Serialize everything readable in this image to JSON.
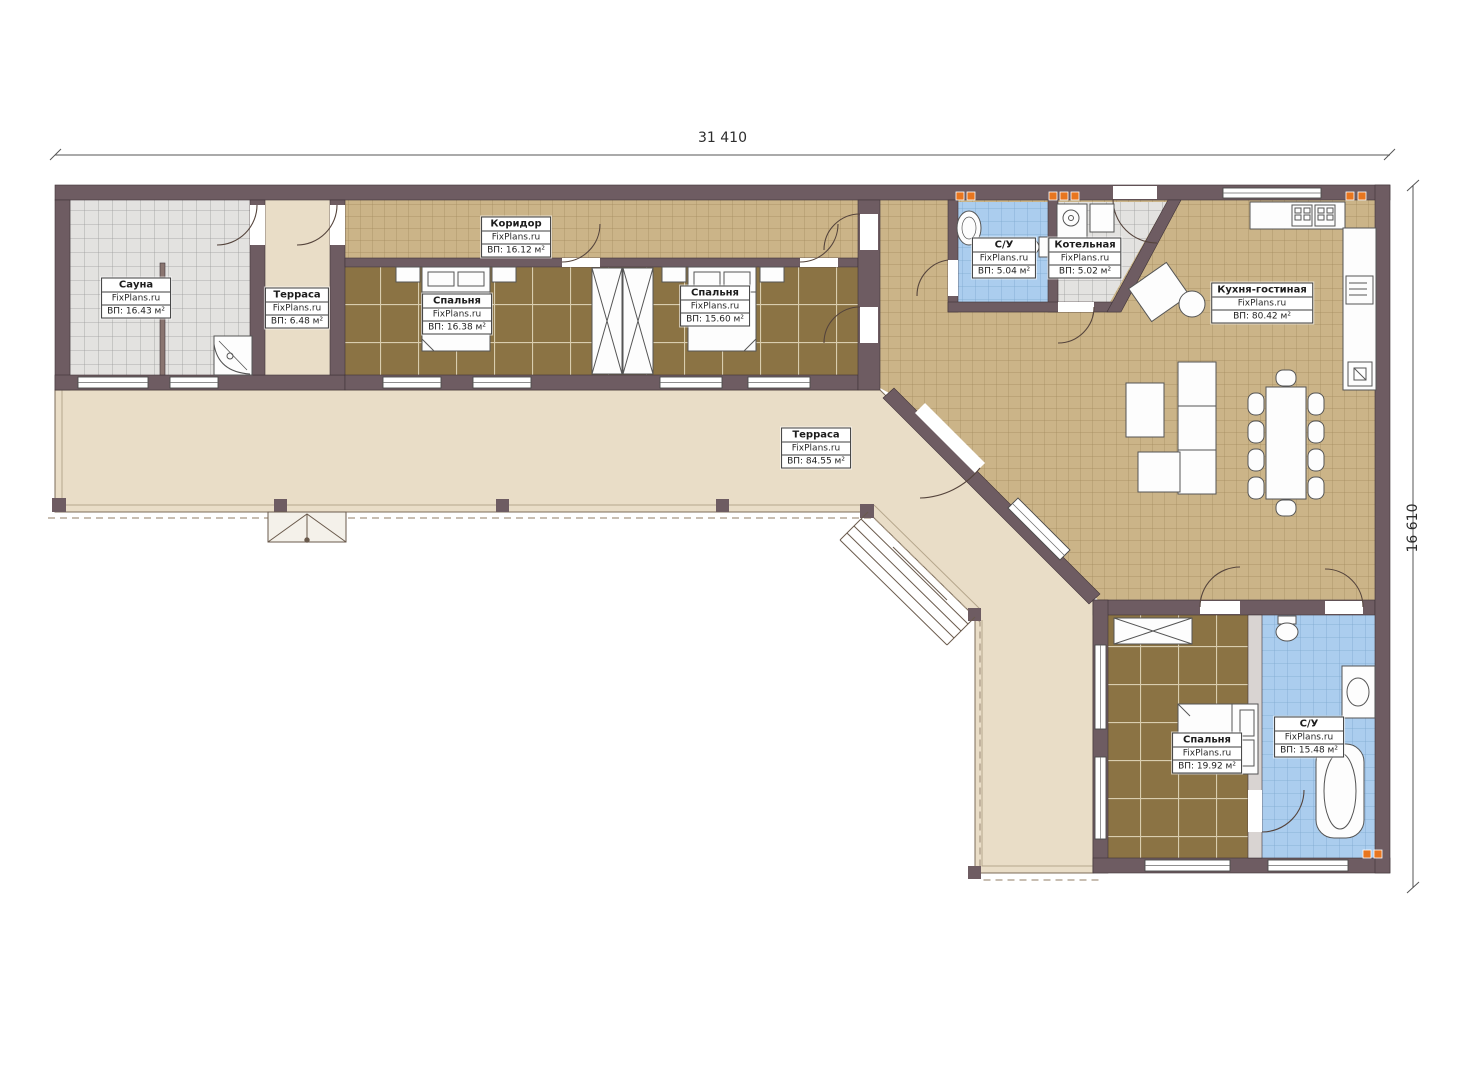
{
  "watermark": "FixPlans.ru",
  "dimensions": {
    "width": "31 410",
    "height": "16 610"
  },
  "rooms": [
    {
      "id": "sauna",
      "name": "Сауна",
      "area": "ВП: 16.43 м²"
    },
    {
      "id": "terrace-small",
      "name": "Терраса",
      "area": "ВП: 6.48 м²"
    },
    {
      "id": "corridor",
      "name": "Коридор",
      "area": "ВП: 16.12 м²"
    },
    {
      "id": "bedroom-1",
      "name": "Спальня",
      "area": "ВП: 16.38 м²"
    },
    {
      "id": "bedroom-2",
      "name": "Спальня",
      "area": "ВП: 15.60 м²"
    },
    {
      "id": "bathroom-1",
      "name": "С/У",
      "area": "ВП: 5.04 м²"
    },
    {
      "id": "boiler-room",
      "name": "Котельная",
      "area": "ВП: 5.02 м²"
    },
    {
      "id": "kitchen-living",
      "name": "Кухня-гостиная",
      "area": "ВП: 80.42 м²"
    },
    {
      "id": "terrace-big",
      "name": "Терраса",
      "area": "ВП: 84.55 м²"
    },
    {
      "id": "bedroom-3",
      "name": "Спальня",
      "area": "ВП: 19.92 м²"
    },
    {
      "id": "bathroom-2",
      "name": "С/У",
      "area": "ВП: 15.48 м²"
    }
  ],
  "colors": {
    "wall": "#6e5c62",
    "floor_tile_tan": "#cbb488",
    "floor_tile_brown": "#8b7344",
    "floor_tile_blue": "#abcdee",
    "floor_tile_gray": "#e3e2e0",
    "terrace": "#e9ddc7",
    "radiator_orange": "#e8761f"
  }
}
